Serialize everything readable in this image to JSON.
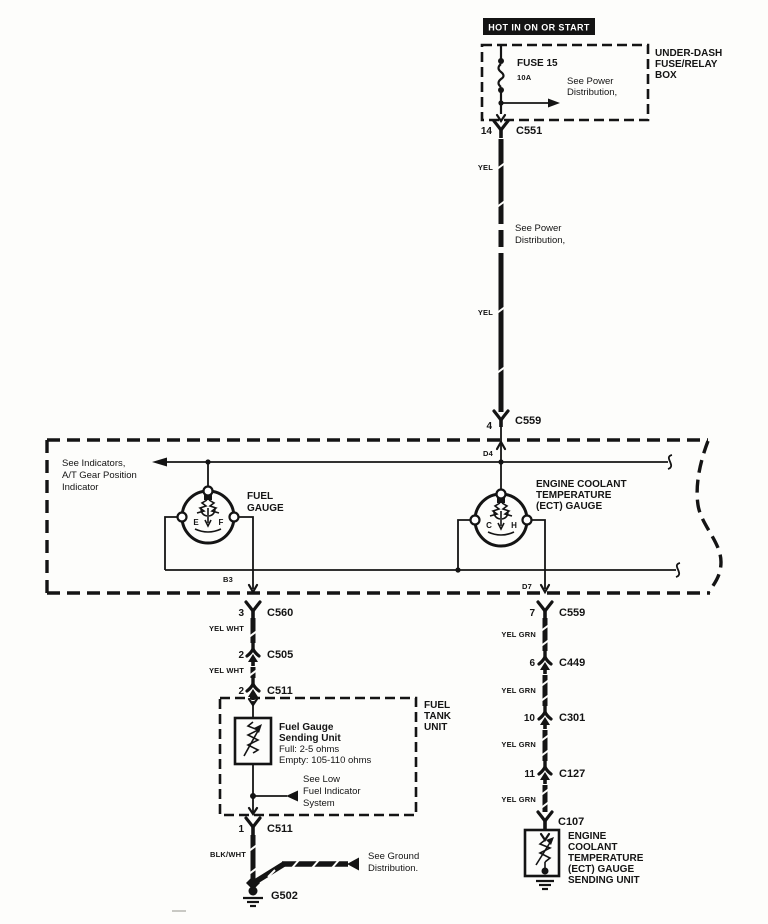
{
  "banner": "HOT IN ON OR START",
  "fusebox": {
    "label": [
      "UNDER-DASH",
      "FUSE/RELAY",
      "BOX"
    ],
    "fuse": "FUSE 15",
    "rating": "10A",
    "note": [
      "See Power",
      "Distribution,"
    ]
  },
  "feed": {
    "pin": "14",
    "conn": "C551",
    "color1": "YEL",
    "note": [
      "See Power",
      "Distribution,"
    ],
    "color2": "YEL",
    "pin2": "4",
    "conn2": "C559",
    "entry_pin": "D4"
  },
  "cluster": {
    "note": [
      "See Indicators,",
      "A/T Gear Position",
      "Indicator"
    ],
    "fuel_gauge": {
      "label": [
        "FUEL",
        "GAUGE"
      ],
      "left": "E",
      "right": "F",
      "exit_pin": "B3"
    },
    "ect_gauge": {
      "label": [
        "ENGINE COOLANT",
        "TEMPERATURE",
        "(ECT) GAUGE"
      ],
      "left": "C",
      "right": "H",
      "exit_pin": "D7"
    }
  },
  "fuel_branch": {
    "pin3": "3",
    "c560": "C560",
    "wire1": "YEL WHT",
    "pin2a": "2",
    "c505": "C505",
    "wire2": "YEL WHT",
    "pin2b": "2",
    "c511": "C511"
  },
  "tank": {
    "label": [
      "FUEL",
      "TANK",
      "UNIT"
    ],
    "sender": [
      "Fuel Gauge",
      "Sending Unit",
      "Full: 2-5 ohms",
      "Empty: 105-110 ohms"
    ],
    "note": [
      "See Low",
      "Fuel Indicator",
      "System"
    ]
  },
  "ground": {
    "pin1": "1",
    "c511": "C511",
    "wire": "BLK/WHT",
    "note": [
      "See Ground",
      "Distribution."
    ],
    "id": "G502"
  },
  "ect_branch": {
    "pin7": "7",
    "c559": "C559",
    "wire1": "YEL GRN",
    "pin6": "6",
    "c449": "C449",
    "wire2": "YEL GRN",
    "pin10": "10",
    "c301": "C301",
    "wire3": "YEL GRN",
    "pin11": "11",
    "c127": "C127",
    "wire4": "YEL GRN",
    "c107": "C107",
    "sender": [
      "ENGINE",
      "COOLANT",
      "TEMPERATURE",
      "(ECT) GAUGE",
      "SENDING UNIT"
    ]
  }
}
